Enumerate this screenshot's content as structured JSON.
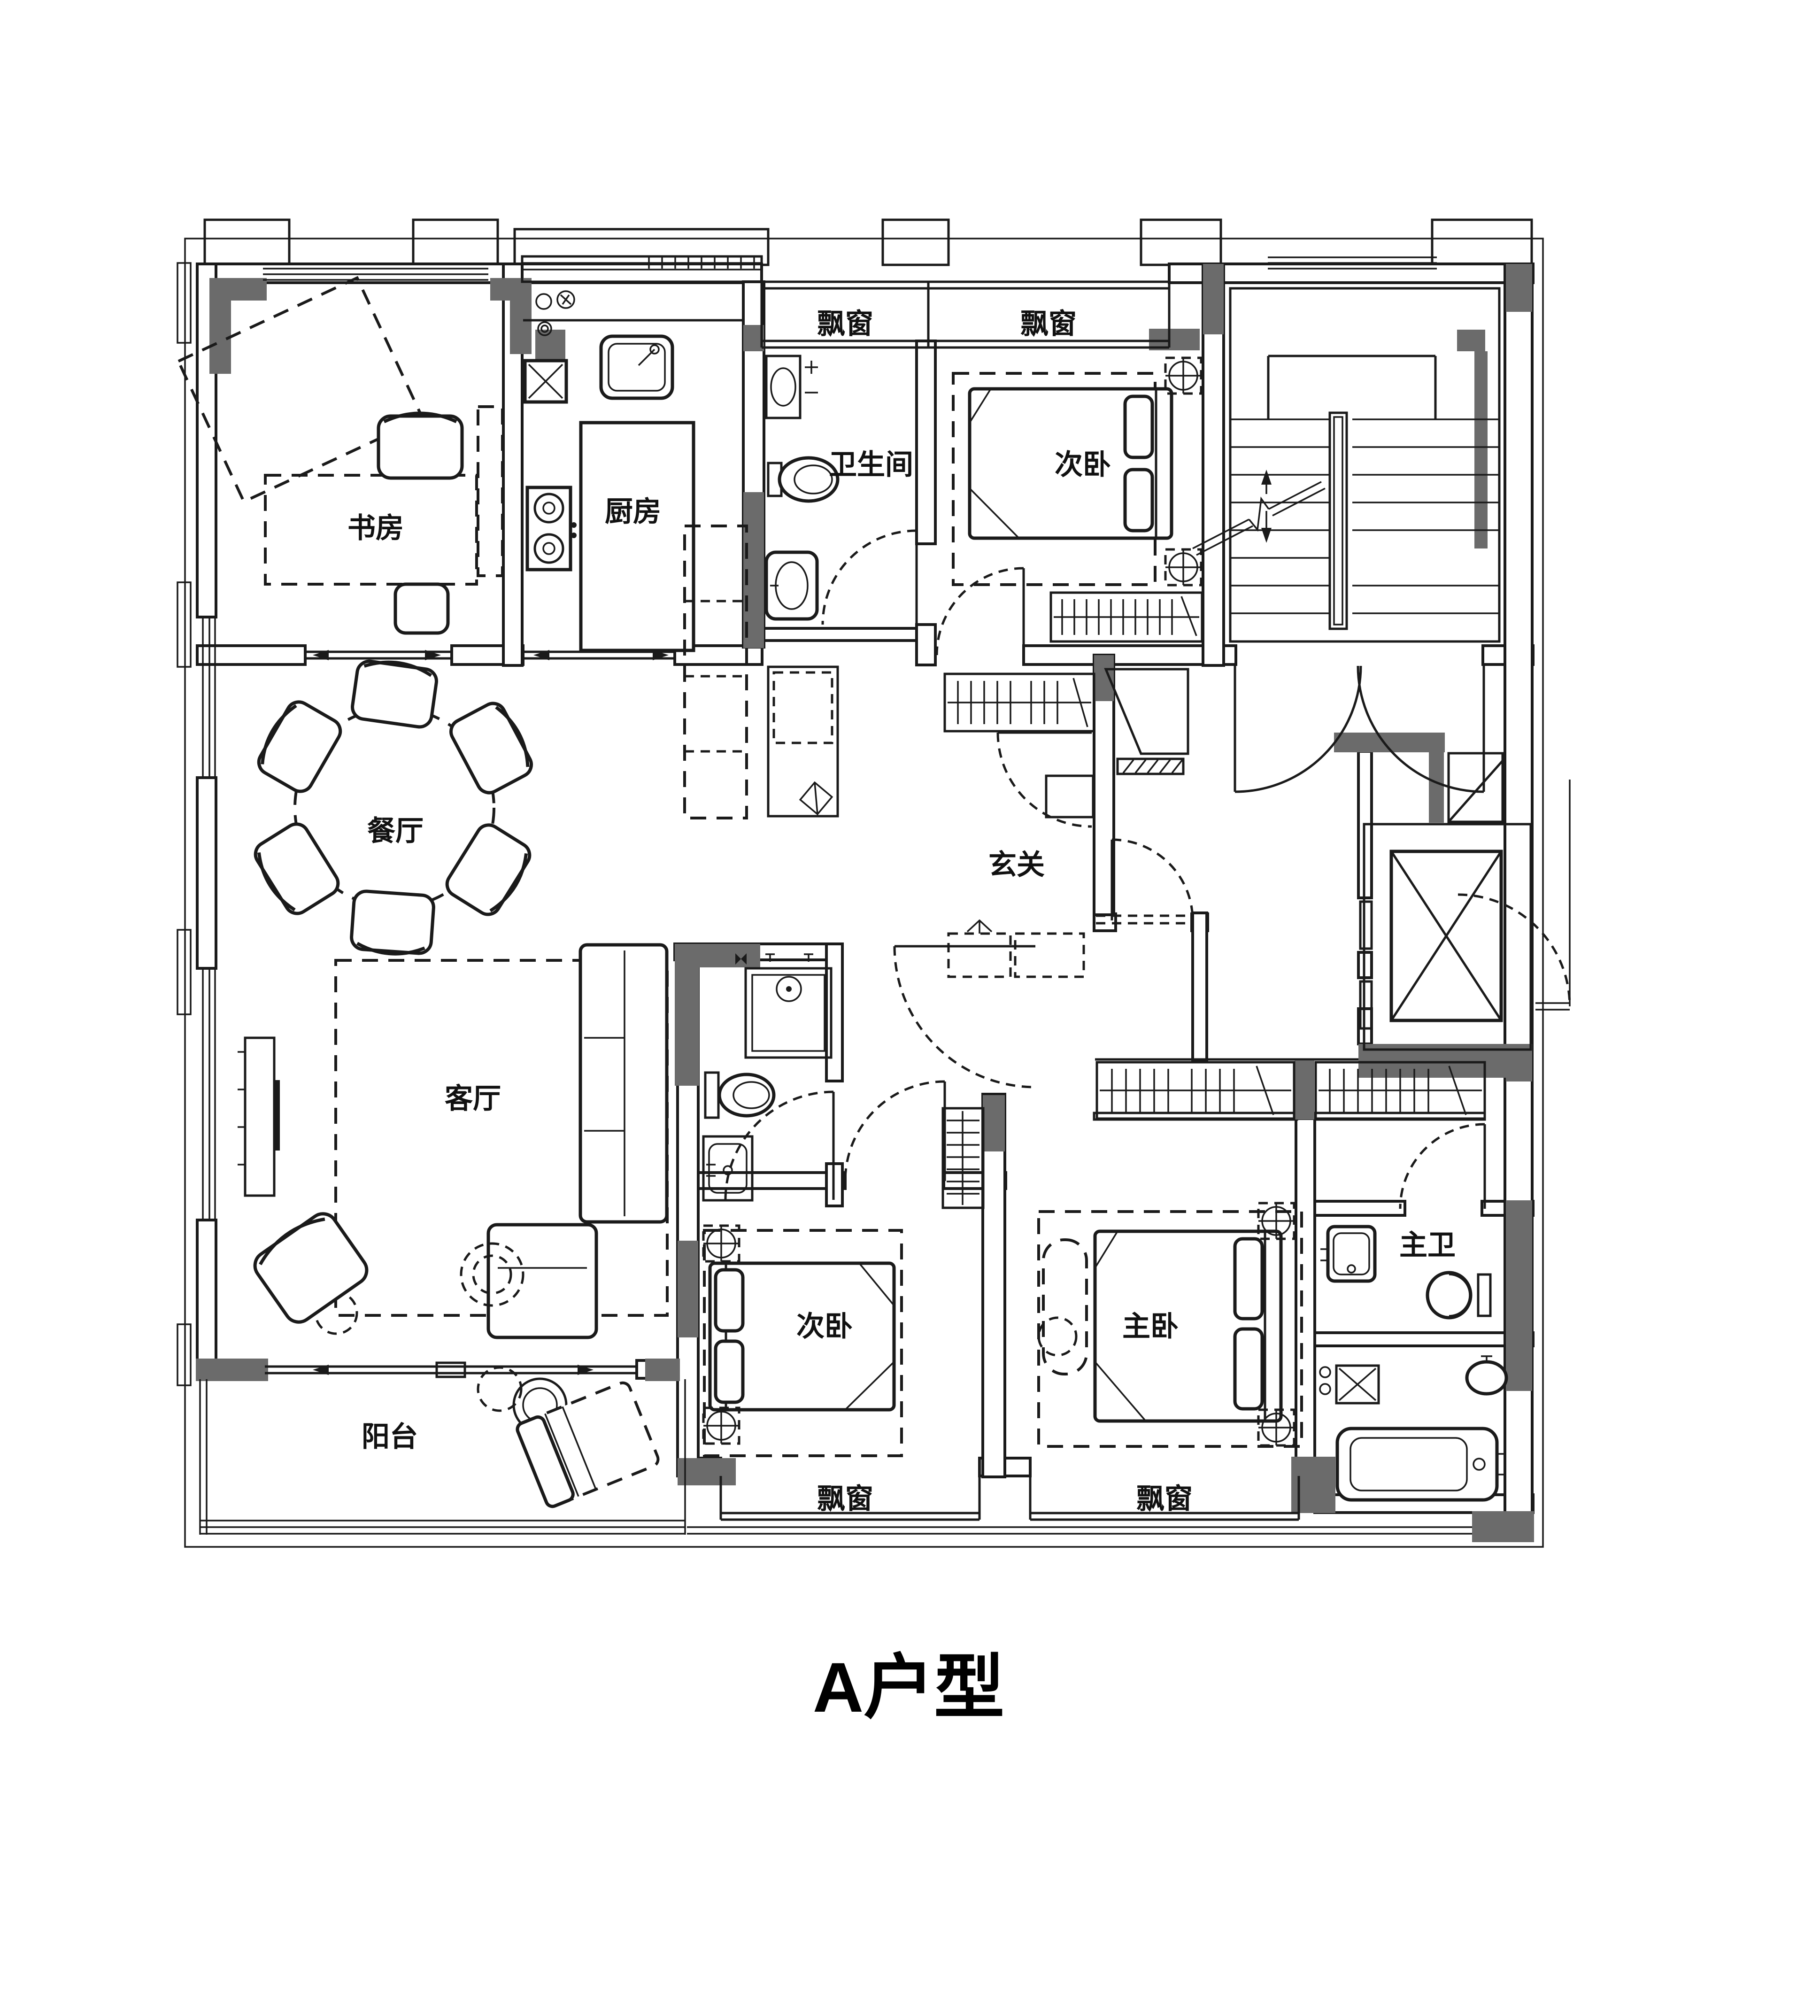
{
  "title": {
    "text": "A户型"
  },
  "labels": {
    "study": "书房",
    "kitchen": "厨房",
    "bathroom": "卫生间",
    "bedroom_second_top": "次卧",
    "bedroom_second_bottom": "次卧",
    "dining": "餐厅",
    "foyer": "玄关",
    "living": "客厅",
    "master_bedroom": "主卧",
    "master_bathroom": "主卫",
    "balcony": "阳台",
    "bay_window": "飘窗"
  },
  "colors": {
    "line": "#1a1a1a",
    "column_fill": "#6b6b6b",
    "background": "#ffffff"
  }
}
